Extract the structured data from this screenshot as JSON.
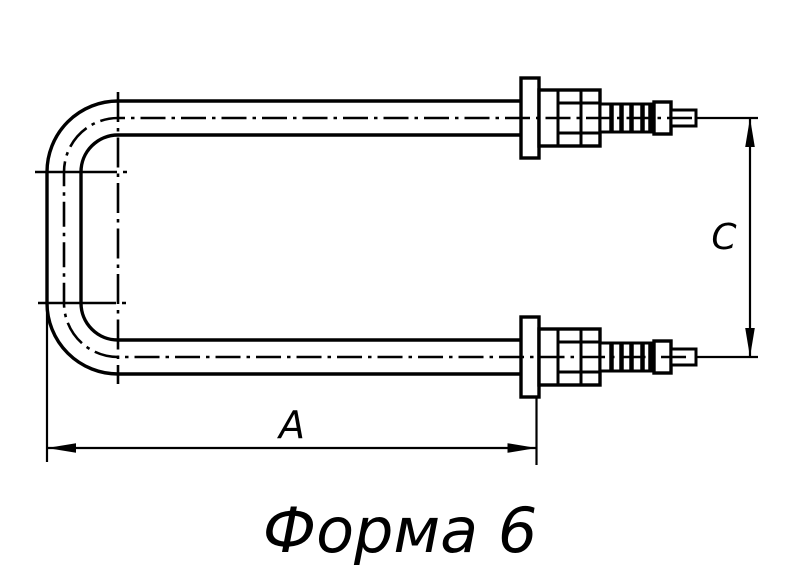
{
  "figure": {
    "title": "Форма 6",
    "dimensions": [
      {
        "axis": "horizontal",
        "label": "A"
      },
      {
        "axis": "vertical",
        "label": "C"
      }
    ],
    "colors": {
      "background": "#ffffff",
      "line": "#000000"
    }
  }
}
